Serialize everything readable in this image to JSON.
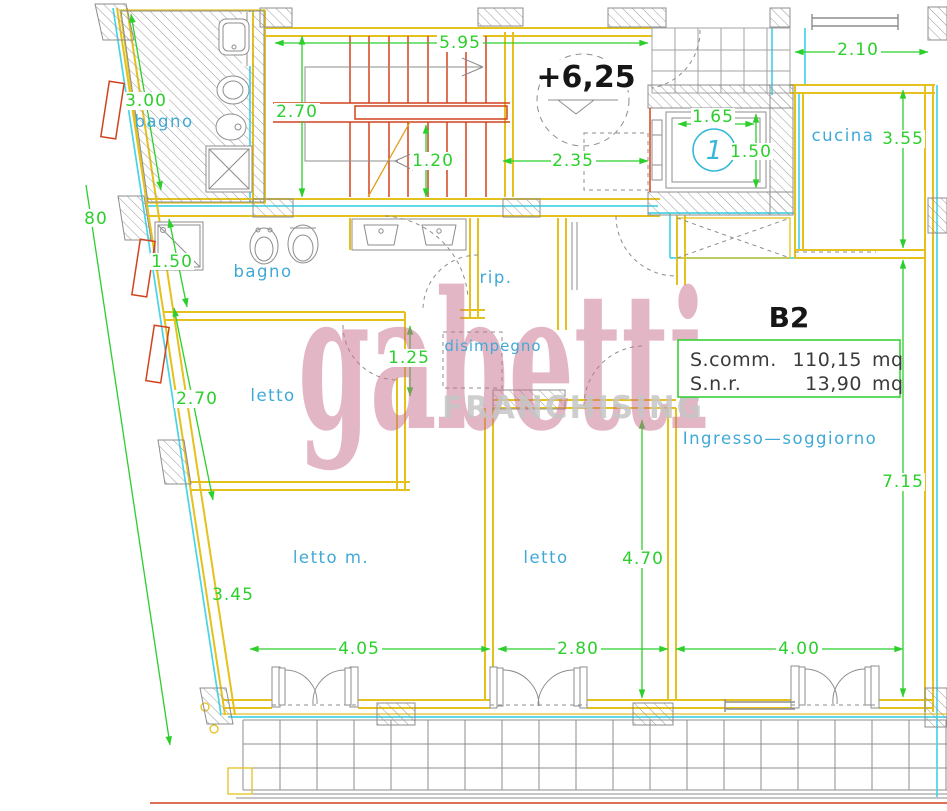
{
  "plan": {
    "unit": {
      "code": "B2",
      "area_rows": [
        {
          "label": "S.comm.",
          "value": "110,15",
          "unit": "mq"
        },
        {
          "label": "S.n.r.",
          "value": "13,90",
          "unit": "mq"
        }
      ]
    },
    "elevation_marker": "+6,25",
    "elevator_number": "1",
    "watermark": {
      "brand": "gabetti",
      "subtitle": "FRANCHISING"
    },
    "rooms": {
      "bagno_top": "bagno",
      "bagno": "bagno",
      "rip": "rip.",
      "disimpegno": "disimpegno",
      "letto": "letto",
      "letto_m": "letto m.",
      "letto2": "letto",
      "cucina": "cucina",
      "soggiorno": "Ingresso—soggiorno"
    },
    "dims": {
      "top_width": "5.95",
      "stair_height": "2.70",
      "stair_flight": "1.20",
      "landing": "2.35",
      "top_right": "2.10",
      "elev_w": "1.65",
      "elev_d": "1.50",
      "cucina_h": "3.55",
      "bagno_top_len": "3.00",
      "wall_80": "80",
      "shower": "1.50",
      "disimpegno_w": "1.25",
      "letto_w": "2.70",
      "soggiorno_h": "7.15",
      "letto2_h": "4.70",
      "letto_m_slant": "3.45",
      "letto_m_w": "4.05",
      "letto2_w": "2.80",
      "soggiorno_w": "4.00"
    },
    "colors": {
      "wall_yellow": "#e4c11c",
      "dimension_green": "#2ccf2c",
      "label_cyan": "#3fa9d6",
      "line_cyan": "#49d4e6",
      "stair_red": "#d2421e",
      "hatch_gray": "#8d8d8d",
      "watermark_pink": "#c96f8d",
      "watermark_gray": "#c6c6c6",
      "text_black": "#161616"
    }
  }
}
